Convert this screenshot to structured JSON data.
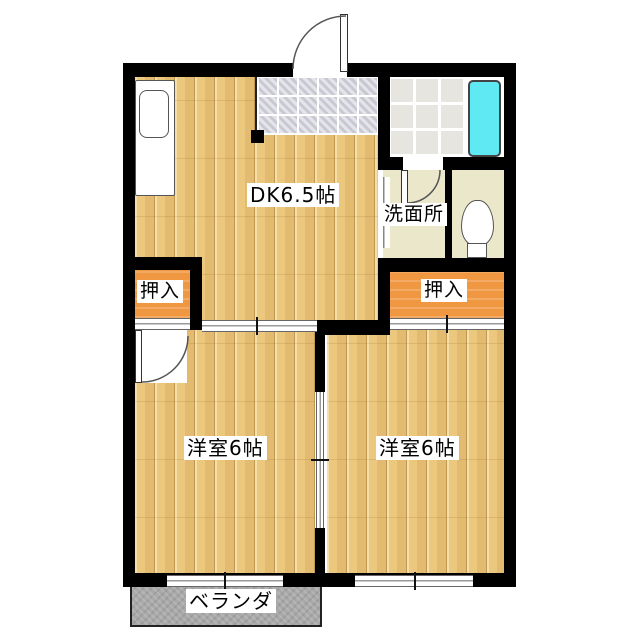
{
  "plan": {
    "title": "apartment-floor-plan",
    "rooms": {
      "dk": "DK6.5帖",
      "washroom": "洗面所",
      "closet_left": "押入",
      "closet_right": "押入",
      "bedroom_left": "洋室6帖",
      "bedroom_right": "洋室6帖",
      "veranda": "ベランダ"
    },
    "fixtures": [
      "kitchen-sink",
      "bathtub",
      "toilet",
      "entrance-door",
      "bath-door",
      "bedroom-door",
      "sliding-doors",
      "windows"
    ],
    "colors": {
      "wall": "#000000",
      "wood_floor": "#ecc87e",
      "closet_orange": "#f09742",
      "washroom_beige": "#eae7cb",
      "genkan_tile": "#d6d6df",
      "bath_tile": "#e7e5e0",
      "bathtub_cyan": "#5fe9f2",
      "veranda_gray": "#a9a9a9",
      "label_bg": "#ffffff",
      "label_text": "#000000"
    }
  }
}
